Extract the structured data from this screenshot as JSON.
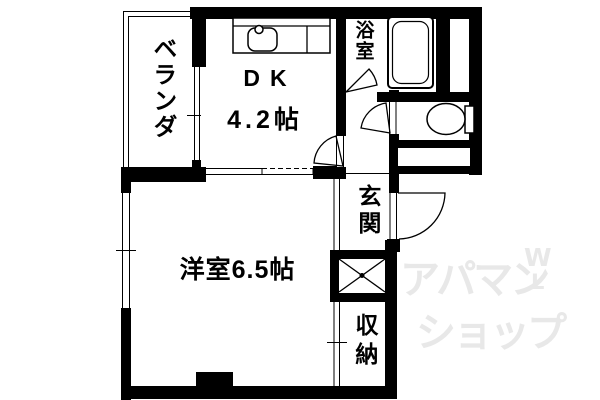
{
  "rooms": {
    "veranda": {
      "label": "ベランダ"
    },
    "dk": {
      "name": "DK",
      "area": "4.2帖"
    },
    "bathroom": {
      "label": "浴室"
    },
    "entrance": {
      "label": "玄関"
    },
    "western": {
      "label": "洋室6.5帖"
    },
    "storage": {
      "label": "収納"
    }
  },
  "watermark": {
    "line1": "アパマン",
    "line2": "ショップ",
    "mark1": "W",
    "mark2": "L",
    "color": "#e8e8e8"
  },
  "colors": {
    "wall": "#000000",
    "background": "#ffffff"
  }
}
